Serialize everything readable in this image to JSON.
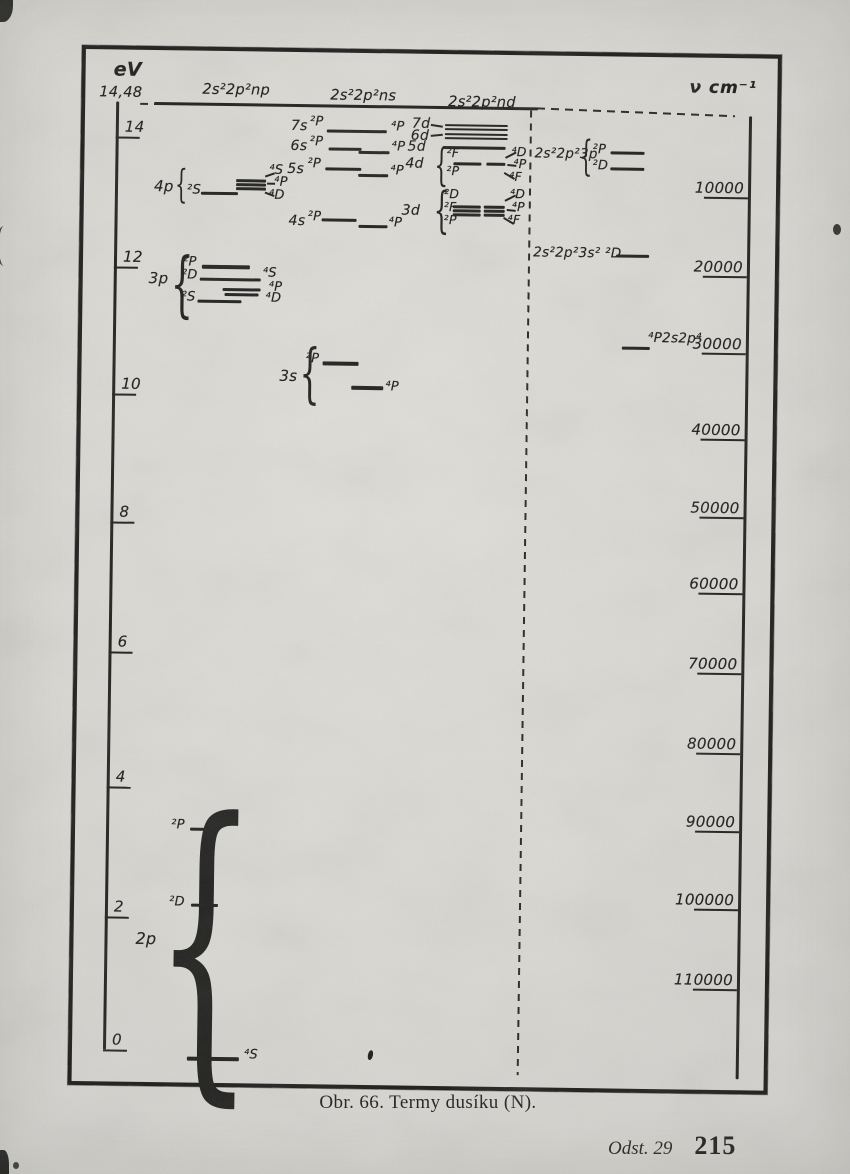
{
  "page": {
    "caption": "Obr. 66. Termy dusíku (N).",
    "footer_section": "Odst. 29",
    "footer_page": "215"
  },
  "colors": {
    "paper": "#d8d7d2",
    "ink": "#1c1c1a"
  },
  "glyphs": {
    "brace": "{"
  },
  "axis_left": {
    "unit": "eV",
    "limit_label": "14,48",
    "ticks": [
      {
        "label": "14",
        "y": 87
      },
      {
        "label": "12",
        "y": 217
      },
      {
        "label": "10",
        "y": 344
      },
      {
        "label": "8",
        "y": 472
      },
      {
        "label": "6",
        "y": 602
      },
      {
        "label": "4",
        "y": 737
      },
      {
        "label": "2",
        "y": 867
      },
      {
        "label": "0",
        "y": 1000
      }
    ]
  },
  "axis_right": {
    "unit": "ν cm⁻¹",
    "ticks": [
      {
        "label": "10000",
        "y": 139
      },
      {
        "label": "20000",
        "y": 218
      },
      {
        "label": "30000",
        "y": 295
      },
      {
        "label": "40000",
        "y": 381
      },
      {
        "label": "50000",
        "y": 459
      },
      {
        "label": "60000",
        "y": 535
      },
      {
        "label": "70000",
        "y": 615
      },
      {
        "label": "80000",
        "y": 695
      },
      {
        "label": "90000",
        "y": 773
      },
      {
        "label": "100000",
        "y": 851
      },
      {
        "label": "110000",
        "y": 931
      }
    ]
  },
  "column_headers": [
    {
      "label": "2s²2p²np",
      "x": 117,
      "y": 31
    },
    {
      "label": "2s²2p²ns",
      "x": 245,
      "y": 35
    },
    {
      "label": "2s²2p²nd",
      "x": 363,
      "y": 40
    }
  ],
  "marks": [
    {
      "t": "h",
      "n": "ionization-limit-line",
      "x": 69,
      "y": 52,
      "w": 384,
      "h": 3
    },
    {
      "t": "dh",
      "n": "limit-dash-left",
      "x": 55,
      "y": 53,
      "w": 15
    },
    {
      "t": "h",
      "n": "left-axis-line",
      "x": 31,
      "y": 52,
      "w": 2.5,
      "h": 948
    },
    {
      "t": "h",
      "n": "right-axis-line",
      "x": 664,
      "y": 58,
      "w": 3,
      "h": 963
    },
    {
      "t": "dh",
      "n": "limit-dash-right",
      "x": 452,
      "y": 52,
      "w": 198,
      "rot": 1.5
    },
    {
      "t": "dv",
      "n": "column-divider-dashed",
      "x": 445,
      "y": 55,
      "hh": 965
    },
    {
      "t": "tx",
      "n": "group-label-4p",
      "x": 70,
      "y": 128,
      "s": 15,
      "v": "4p"
    },
    {
      "t": "br",
      "x": 91,
      "y": 120,
      "hh": 30
    },
    {
      "t": "tx",
      "x": 103,
      "y": 133,
      "s": 13,
      "v": "²S"
    },
    {
      "t": "h",
      "x": 117,
      "y": 141,
      "w": 37,
      "h": 3
    },
    {
      "t": "h",
      "x": 152,
      "y": 128,
      "w": 30,
      "h": 2.5
    },
    {
      "t": "h",
      "x": 152,
      "y": 132,
      "w": 30,
      "h": 2.5
    },
    {
      "t": "h",
      "x": 152,
      "y": 136,
      "w": 30,
      "h": 2.5
    },
    {
      "t": "st",
      "x": 181,
      "y": 124,
      "w": 10,
      "rot": -20
    },
    {
      "t": "st",
      "x": 183,
      "y": 131,
      "w": 8,
      "rot": 0
    },
    {
      "t": "st",
      "x": 181,
      "y": 140,
      "w": 10,
      "rot": 20
    },
    {
      "t": "tx",
      "x": 185,
      "y": 112,
      "s": 13,
      "v": "⁴S"
    },
    {
      "t": "tx",
      "x": 190,
      "y": 124,
      "s": 13,
      "v": "⁴P"
    },
    {
      "t": "tx",
      "x": 185,
      "y": 137,
      "s": 13,
      "v": "⁴D"
    },
    {
      "t": "tx",
      "n": "group-label-3p",
      "x": 66,
      "y": 220,
      "s": 15,
      "v": "3p"
    },
    {
      "t": "br",
      "x": 88,
      "y": 206,
      "hh": 55
    },
    {
      "t": "tx",
      "x": 100,
      "y": 205,
      "s": 13,
      "v": "²P"
    },
    {
      "t": "h",
      "x": 119,
      "y": 214,
      "w": 48,
      "h": 3.5
    },
    {
      "t": "tx",
      "x": 99,
      "y": 218,
      "s": 13,
      "v": "²D"
    },
    {
      "t": "h",
      "x": 117,
      "y": 227,
      "w": 61,
      "h": 3
    },
    {
      "t": "tx",
      "x": 180,
      "y": 215,
      "s": 13,
      "v": "⁴S"
    },
    {
      "t": "h",
      "x": 140,
      "y": 237,
      "w": 38,
      "h": 3
    },
    {
      "t": "tx",
      "x": 186,
      "y": 229,
      "s": 13,
      "v": "⁴P"
    },
    {
      "t": "h",
      "x": 142,
      "y": 242,
      "w": 34,
      "h": 2.5
    },
    {
      "t": "tx",
      "x": 183,
      "y": 240,
      "s": 13,
      "v": "⁴D"
    },
    {
      "t": "tx",
      "x": 99,
      "y": 240,
      "s": 13,
      "v": "²S"
    },
    {
      "t": "h",
      "x": 115,
      "y": 249,
      "w": 44,
      "h": 3
    },
    {
      "t": "tx",
      "n": "group-label-3s",
      "x": 198,
      "y": 316,
      "s": 15,
      "v": "3s"
    },
    {
      "t": "br",
      "x": 218,
      "y": 297,
      "hh": 50
    },
    {
      "t": "tx",
      "x": 224,
      "y": 300,
      "s": 13,
      "v": "²P"
    },
    {
      "t": "h",
      "x": 241,
      "y": 309,
      "w": 36,
      "h": 3.5
    },
    {
      "t": "h",
      "x": 270,
      "y": 333,
      "w": 32,
      "h": 3.5
    },
    {
      "t": "tx",
      "x": 304,
      "y": 327,
      "s": 13,
      "v": "⁴P"
    },
    {
      "t": "tx",
      "x": 206,
      "y": 66,
      "s": 14,
      "v": "7s"
    },
    {
      "t": "tx",
      "x": 225,
      "y": 63,
      "s": 13,
      "v": "²P"
    },
    {
      "t": "h",
      "x": 242,
      "y": 77,
      "w": 60,
      "h": 3
    },
    {
      "t": "tx",
      "x": 306,
      "y": 67,
      "s": 13,
      "v": "⁴P"
    },
    {
      "t": "tx",
      "x": 206,
      "y": 86,
      "s": 14,
      "v": "6s"
    },
    {
      "t": "tx",
      "x": 225,
      "y": 83,
      "s": 13,
      "v": "²P"
    },
    {
      "t": "h",
      "x": 244,
      "y": 95,
      "w": 33,
      "h": 2.5
    },
    {
      "t": "h",
      "x": 274,
      "y": 98,
      "w": 31,
      "h": 2.5
    },
    {
      "t": "tx",
      "x": 307,
      "y": 87,
      "s": 13,
      "v": "⁴P"
    },
    {
      "t": "tx",
      "x": 203,
      "y": 109,
      "s": 14,
      "v": "5s"
    },
    {
      "t": "tx",
      "x": 223,
      "y": 105,
      "s": 13,
      "v": "²P"
    },
    {
      "t": "h",
      "x": 241,
      "y": 115,
      "w": 36,
      "h": 2.5
    },
    {
      "t": "h",
      "x": 274,
      "y": 121,
      "w": 30,
      "h": 2.5
    },
    {
      "t": "tx",
      "x": 306,
      "y": 111,
      "s": 13,
      "v": "⁴P"
    },
    {
      "t": "tx",
      "x": 205,
      "y": 161,
      "s": 14,
      "v": "4s"
    },
    {
      "t": "tx",
      "x": 224,
      "y": 158,
      "s": 13,
      "v": "²P"
    },
    {
      "t": "h",
      "x": 238,
      "y": 166,
      "w": 35,
      "h": 3
    },
    {
      "t": "h",
      "x": 275,
      "y": 172,
      "w": 29,
      "h": 3
    },
    {
      "t": "tx",
      "x": 305,
      "y": 163,
      "s": 13,
      "v": "⁴P"
    },
    {
      "t": "tx",
      "x": 327,
      "y": 62,
      "s": 14,
      "v": "7d"
    },
    {
      "t": "st",
      "x": 346,
      "y": 70,
      "w": 12,
      "rot": 8
    },
    {
      "t": "h",
      "x": 360,
      "y": 70,
      "w": 63,
      "h": 2.2
    },
    {
      "t": "h",
      "x": 360,
      "y": 74,
      "w": 63,
      "h": 2.2
    },
    {
      "t": "tx",
      "x": 326,
      "y": 74,
      "s": 14,
      "v": "6d"
    },
    {
      "t": "st",
      "x": 346,
      "y": 81,
      "w": 12,
      "rot": -6
    },
    {
      "t": "h",
      "x": 360,
      "y": 79,
      "w": 63,
      "h": 2.2
    },
    {
      "t": "h",
      "x": 360,
      "y": 83,
      "w": 63,
      "h": 2.2
    },
    {
      "t": "tx",
      "x": 323,
      "y": 85,
      "s": 14,
      "v": "5d"
    },
    {
      "t": "h",
      "x": 358,
      "y": 92,
      "w": 63,
      "h": 2.5
    },
    {
      "t": "tx",
      "x": 321,
      "y": 102,
      "s": 14,
      "v": "4d"
    },
    {
      "t": "br",
      "x": 350,
      "y": 95,
      "hh": 34
    },
    {
      "t": "tx",
      "x": 362,
      "y": 92,
      "s": 12.5,
      "v": "²F"
    },
    {
      "t": "tx",
      "x": 362,
      "y": 110,
      "s": 12.5,
      "v": "²P"
    },
    {
      "t": "h",
      "x": 369,
      "y": 108,
      "w": 28,
      "h": 2.5
    },
    {
      "t": "h",
      "x": 402,
      "y": 108,
      "w": 19,
      "h": 2.5
    },
    {
      "t": "st",
      "x": 421,
      "y": 102,
      "w": 12,
      "rot": -28
    },
    {
      "t": "st",
      "x": 423,
      "y": 109,
      "w": 9,
      "rot": 5
    },
    {
      "t": "st",
      "x": 420,
      "y": 117,
      "w": 12,
      "rot": 30
    },
    {
      "t": "tx",
      "x": 427,
      "y": 90,
      "s": 12.5,
      "v": "⁴D"
    },
    {
      "t": "tx",
      "x": 429,
      "y": 102,
      "s": 12.5,
      "v": "⁴P"
    },
    {
      "t": "tx",
      "x": 425,
      "y": 115,
      "s": 12.5,
      "v": "⁴F"
    },
    {
      "t": "tx",
      "x": 318,
      "y": 149,
      "s": 14,
      "v": "3d"
    },
    {
      "t": "br",
      "x": 350,
      "y": 137,
      "hh": 38
    },
    {
      "t": "tx",
      "x": 360,
      "y": 133,
      "s": 12.5,
      "v": "²D"
    },
    {
      "t": "tx",
      "x": 360,
      "y": 146,
      "s": 12.5,
      "v": "²F"
    },
    {
      "t": "tx",
      "x": 360,
      "y": 159,
      "s": 12.5,
      "v": "²P"
    },
    {
      "t": "h",
      "x": 369,
      "y": 151,
      "w": 28,
      "h": 3
    },
    {
      "t": "h",
      "x": 400,
      "y": 151,
      "w": 21,
      "h": 3
    },
    {
      "t": "h",
      "x": 369,
      "y": 155,
      "w": 28,
      "h": 3
    },
    {
      "t": "h",
      "x": 400,
      "y": 155,
      "w": 21,
      "h": 3
    },
    {
      "t": "h",
      "x": 369,
      "y": 159,
      "w": 28,
      "h": 3
    },
    {
      "t": "h",
      "x": 400,
      "y": 159,
      "w": 21,
      "h": 3
    },
    {
      "t": "st",
      "x": 421,
      "y": 145,
      "w": 12,
      "rot": -28
    },
    {
      "t": "st",
      "x": 423,
      "y": 154,
      "w": 9,
      "rot": 5
    },
    {
      "t": "st",
      "x": 420,
      "y": 162,
      "w": 12,
      "rot": 30
    },
    {
      "t": "tx",
      "x": 426,
      "y": 132,
      "s": 12.5,
      "v": "⁴D"
    },
    {
      "t": "tx",
      "x": 428,
      "y": 145,
      "s": 12.5,
      "v": "⁴P"
    },
    {
      "t": "tx",
      "x": 424,
      "y": 158,
      "s": 12.5,
      "v": "⁴F"
    },
    {
      "t": "tx",
      "n": "config-label-3p",
      "x": 450,
      "y": 91,
      "s": 13.5,
      "v": "2s²2p²3p"
    },
    {
      "t": "br",
      "x": 495,
      "y": 84,
      "hh": 32
    },
    {
      "t": "tx",
      "x": 508,
      "y": 87,
      "s": 13,
      "v": "²P"
    },
    {
      "t": "h",
      "x": 526,
      "y": 95,
      "w": 34,
      "h": 3
    },
    {
      "t": "tx",
      "x": 508,
      "y": 103,
      "s": 13,
      "v": "²D"
    },
    {
      "t": "h",
      "x": 526,
      "y": 111,
      "w": 34,
      "h": 3
    },
    {
      "t": "tx",
      "n": "config-label-3s",
      "x": 450,
      "y": 190,
      "s": 13.5,
      "v": "2s²2p²3s² ²D"
    },
    {
      "t": "h",
      "x": 533,
      "y": 198,
      "w": 33,
      "h": 3
    },
    {
      "t": "h",
      "x": 540,
      "y": 290,
      "w": 28,
      "h": 3
    },
    {
      "t": "tx",
      "n": "config-label-2s2p4",
      "x": 566,
      "y": 274,
      "s": 13.5,
      "v": "⁴P2s2p⁴"
    },
    {
      "t": "br",
      "x": 80,
      "y": 768,
      "hh": 250
    },
    {
      "t": "tx",
      "n": "group-label-2p",
      "x": 62,
      "y": 880,
      "s": 16,
      "v": "2p"
    },
    {
      "t": "tx",
      "x": 96,
      "y": 768,
      "s": 13,
      "v": "²P"
    },
    {
      "t": "h",
      "x": 115,
      "y": 777,
      "w": 28,
      "h": 3
    },
    {
      "t": "tx",
      "x": 95,
      "y": 845,
      "s": 13,
      "v": "²D"
    },
    {
      "t": "h",
      "x": 117,
      "y": 853,
      "w": 27,
      "h": 3
    },
    {
      "t": "h",
      "x": 115,
      "y": 1006,
      "w": 52,
      "h": 3.5
    },
    {
      "t": "tx",
      "x": 172,
      "y": 997,
      "s": 13,
      "v": "⁴S"
    },
    {
      "t": "bl",
      "n": "ink-blob",
      "x": 296,
      "y": 997,
      "w": 5,
      "hh": 10,
      "rot": 12
    }
  ],
  "chart_data": {
    "type": "energy-level-diagram",
    "title": "Termy dusíku (N)",
    "element": "N",
    "ionization_limit_eV": 14.48,
    "axis_left": {
      "label": "eV",
      "range": [
        0,
        14.48
      ]
    },
    "axis_right": {
      "label": "ν cm⁻¹",
      "ticks": [
        10000,
        20000,
        30000,
        40000,
        50000,
        60000,
        70000,
        80000,
        90000,
        100000,
        110000
      ]
    },
    "columns": [
      "2s²2p²np",
      "2s²2p²ns",
      "2s²2p²nd"
    ],
    "levels": [
      {
        "config": "2p",
        "term": "⁴S",
        "eV": 0.0
      },
      {
        "config": "2p",
        "term": "²D",
        "eV": 2.2
      },
      {
        "config": "2p",
        "term": "²P",
        "eV": 3.4
      },
      {
        "config": "3s",
        "term": "⁴P",
        "eV": 10.1
      },
      {
        "config": "3s",
        "term": "²P",
        "eV": 10.5
      },
      {
        "config": "2s2p⁴",
        "term": "⁴P",
        "eV": 10.8
      },
      {
        "config": "3p",
        "term": "²S",
        "eV": 11.5
      },
      {
        "config": "3p",
        "term": "⁴D",
        "eV": 11.6
      },
      {
        "config": "3p",
        "term": "⁴P",
        "eV": 11.65
      },
      {
        "config": "3p",
        "term": "²D",
        "eV": 11.8
      },
      {
        "config": "3p",
        "term": "⁴S",
        "eV": 11.8
      },
      {
        "config": "3p",
        "term": "²P",
        "eV": 12.0
      },
      {
        "config": "2s²2p²3s²",
        "term": "²D",
        "eV": 12.2
      },
      {
        "config": "4s",
        "term": "⁴P",
        "eV": 12.6
      },
      {
        "config": "4s",
        "term": "²P",
        "eV": 12.7
      },
      {
        "config": "3d",
        "term": "²D ²F ²P ⁴D ⁴P ⁴F",
        "eV": 12.9
      },
      {
        "config": "4p",
        "term": "²S",
        "eV": 13.1
      },
      {
        "config": "4p",
        "term": "⁴S ⁴P ⁴D",
        "eV": 13.3
      },
      {
        "config": "5s",
        "term": "⁴P",
        "eV": 13.4
      },
      {
        "config": "5s",
        "term": "²P",
        "eV": 13.5
      },
      {
        "config": "2s²2p²3p",
        "term": "²D",
        "eV": 13.5
      },
      {
        "config": "4d",
        "term": "²F ²P ⁴D ⁴P ⁴F",
        "eV": 13.6
      },
      {
        "config": "2s²2p²3p",
        "term": "²P",
        "eV": 13.75
      },
      {
        "config": "6s",
        "term": "²P ⁴P",
        "eV": 13.8
      },
      {
        "config": "5d",
        "term": "",
        "eV": 13.8
      },
      {
        "config": "6d",
        "term": "",
        "eV": 14.0
      },
      {
        "config": "7s",
        "term": "²P ⁴P",
        "eV": 14.1
      },
      {
        "config": "7d",
        "term": "",
        "eV": 14.15
      }
    ]
  }
}
